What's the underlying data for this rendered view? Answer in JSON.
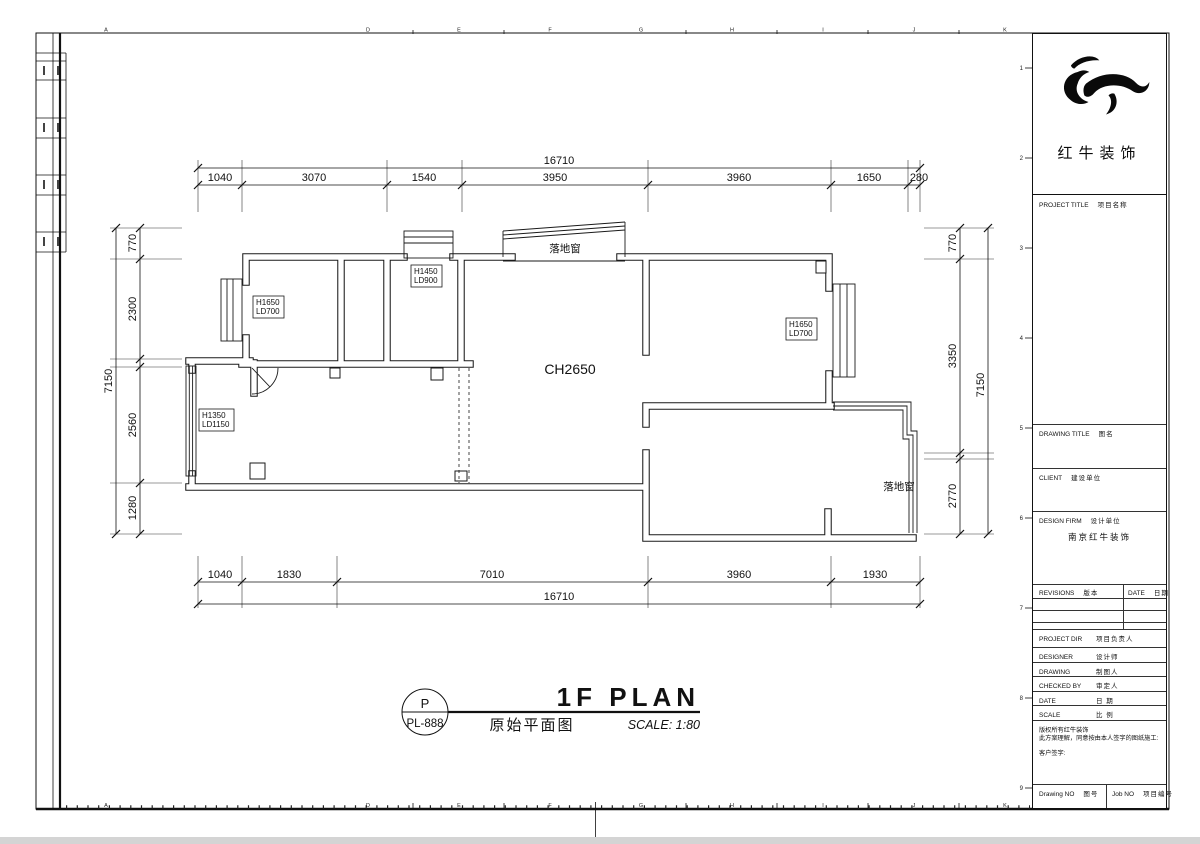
{
  "sheet": {
    "bottom_ruler_letters": [
      "A",
      "D",
      "E",
      "F",
      "G",
      "H",
      "I",
      "J",
      "K"
    ],
    "top_ruler_letters": [
      "A",
      "D",
      "E",
      "F",
      "G",
      "H",
      "I",
      "J",
      "K"
    ],
    "row_numbers": [
      "1",
      "2",
      "3",
      "4",
      "5",
      "6",
      "7",
      "8",
      "9"
    ]
  },
  "plan": {
    "ceiling_height": "CH2650",
    "window_label_top": "落地窗",
    "window_label_right": "落地窗",
    "window_tags": [
      {
        "height": "H1650",
        "width": "LD700"
      },
      {
        "height": "H1450",
        "width": "LD900"
      },
      {
        "height": "H1350",
        "width": "LD1150"
      },
      {
        "height": "H1650",
        "width": "LD700"
      }
    ]
  },
  "dimensions": {
    "top": {
      "total": "16710",
      "segments": [
        "1040",
        "3070",
        "1540",
        "3950",
        "3960",
        "1650",
        "280"
      ]
    },
    "bottom": {
      "total": "16710",
      "segments": [
        "1040",
        "1830",
        "7010",
        "3960",
        "1930"
      ]
    },
    "left": {
      "total": "7150",
      "segments": [
        "770",
        "2300",
        "2560",
        "1280"
      ]
    },
    "right": {
      "total": "7150",
      "segments": [
        "770",
        "3350",
        "2770"
      ]
    }
  },
  "title_bar": {
    "badge_letter": "P",
    "badge_code": "PL-888",
    "title": "1F PLAN",
    "subtitle": "原始平面图",
    "scale": "SCALE: 1:80"
  },
  "title_block": {
    "brand": "红牛装饰",
    "project_title_en": "PROJECT TITLE",
    "project_title_cn": "项目名称",
    "drawing_title_en": "DRAWING TITLE",
    "drawing_title_cn": "图名",
    "client_en": "CLIENT",
    "client_cn": "建设单位",
    "design_firm_en": "DESIGN FIRM",
    "design_firm_cn": "设计单位",
    "design_firm_name": "南京红牛装饰",
    "revisions_en": "REVISIONS",
    "revisions_cn": "版本",
    "rev_date_en": "DATE",
    "rev_date_cn": "日期",
    "rows": [
      {
        "en": "PROJECT DIR",
        "cn": "项目负责人"
      },
      {
        "en": "DESIGNER",
        "cn": "设计师"
      },
      {
        "en": "DRAWING",
        "cn": "制图人"
      },
      {
        "en": "CHECKED BY",
        "cn": "审定人"
      },
      {
        "en": "DATE",
        "cn": "日 期"
      },
      {
        "en": "SCALE",
        "cn": "比 例"
      }
    ],
    "notes": [
      "版权所有红牛装饰",
      "此方案理解，同意按由本人签字的图纸施工:",
      "客户签字:"
    ],
    "drawing_no_en": "Drawing NO",
    "drawing_no_cn": "图号",
    "job_no_en": "Job NO",
    "job_no_cn": "项目编号"
  }
}
